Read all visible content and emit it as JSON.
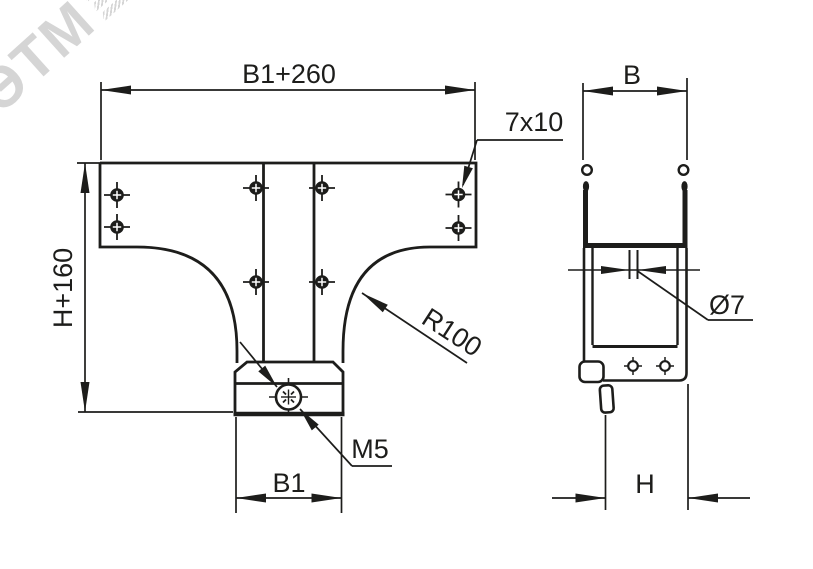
{
  "drawing": {
    "watermark": "ЭТМ",
    "front_view": {
      "top_width_dim": "B1+260",
      "left_height_dim": "H+160",
      "slot_label": "7x10",
      "radius_label": "R100",
      "thread_label": "M5",
      "bottom_width_dim": "B1"
    },
    "side_view": {
      "top_width_dim": "B",
      "hole_dia_label": "Ø7",
      "bottom_height_dim": "H"
    }
  },
  "colors": {
    "line": "#1d1d1b",
    "watermark": "#c8c8c8",
    "background": "#ffffff"
  }
}
